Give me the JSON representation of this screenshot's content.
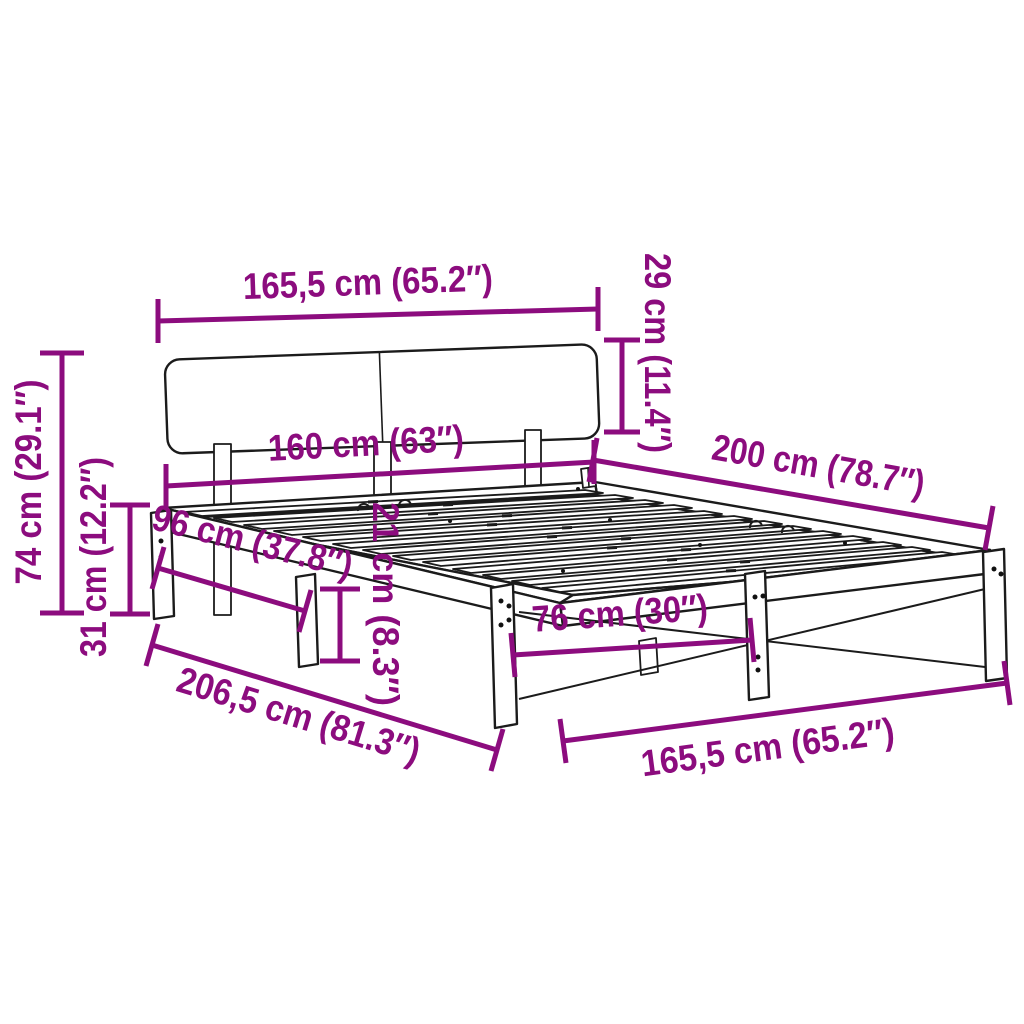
{
  "figure": {
    "kind": "product-dimension-diagram",
    "subject": "bed frame with headboard and slatted base",
    "background_color": "#ffffff",
    "drawing_color": "#1b1b1b",
    "accent_color": "#8C0C7E"
  },
  "dimensions": [
    {
      "id": "headboard-width",
      "text": "165,5 cm (65.2″)"
    },
    {
      "id": "headboard-height",
      "text": "29 cm (11.4″)"
    },
    {
      "id": "inner-width",
      "text": "160 cm (63″)"
    },
    {
      "id": "frame-length",
      "text": "200 cm (78.7″)"
    },
    {
      "id": "total-height",
      "text": "74 cm (29.1″)"
    },
    {
      "id": "base-height",
      "text": "31 cm (12.2″)"
    },
    {
      "id": "leg-spacing-side",
      "text": "96 cm (37.8″)"
    },
    {
      "id": "frame-height",
      "text": "21 cm (8.3″)"
    },
    {
      "id": "leg-spacing-foot",
      "text": "76 cm (30″)"
    },
    {
      "id": "total-length",
      "text": "206,5 cm (81.3″)"
    },
    {
      "id": "frame-width",
      "text": "165,5 cm (65.2″)"
    }
  ]
}
